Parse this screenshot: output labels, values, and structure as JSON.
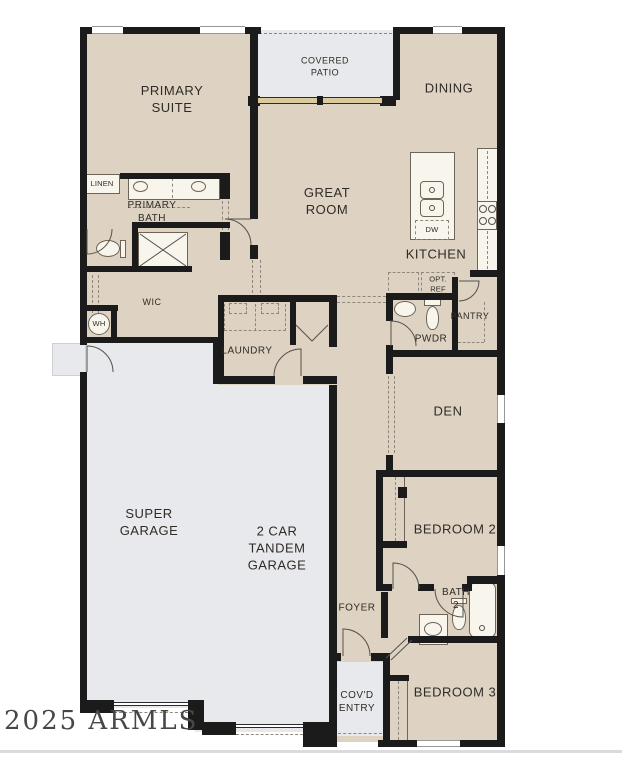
{
  "labels": {
    "primary_suite": "PRIMARY\nSUITE",
    "covered_patio": "COVERED\nPATIO",
    "dining": "DINING",
    "primary_bath": "PRIMARY\nBATH",
    "linen": "LINEN",
    "great_room": "GREAT\nROOM",
    "kitchen": "KITCHEN",
    "dishwasher": "DW",
    "optional_refrigerator": "OPT.\nREF",
    "walk_in_closet": "WIC",
    "water_heater": "WH",
    "laundry": "LAUNDRY",
    "pantry": "PANTRY",
    "powder_room": "PWDR",
    "den": "DEN",
    "super_garage": "SUPER\nGARAGE",
    "tandem_garage": "2 CAR\nTANDEM\nGARAGE",
    "bedroom_2": "BEDROOM 2",
    "bath_2": "BATH\n2",
    "foyer": "FOYER",
    "covered_entry": "COV'D\nENTRY",
    "bedroom_3": "BEDROOM 3"
  },
  "watermark": "2025 ARMLS",
  "colors": {
    "floor": "#ded3c2",
    "patio_garage_entry": "#e8e9ec",
    "wall": "#1b1b1b"
  }
}
